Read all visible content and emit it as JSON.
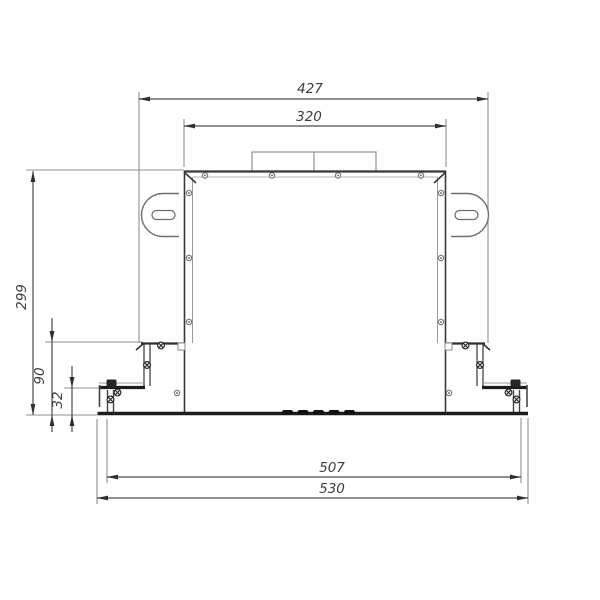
{
  "drawing": {
    "type": "technical-front-view-dimension-drawing",
    "dimensions": {
      "upper_width": "427",
      "body_width": "320",
      "body_height": "299",
      "bracket_height": "90",
      "foot_height": "32",
      "feet_span": "507",
      "base_width": "530"
    },
    "icons": {
      "screw": "screw-icon",
      "bolt": "bolt-icon"
    },
    "colors": {
      "background": "#ffffff",
      "outline_dark": "#2e2e2e",
      "line_medium": "#4a4a4a",
      "line_light": "#8f8f8f",
      "thick_black": "#1d1d1d",
      "dimension_text": "#3c3c3c"
    }
  }
}
